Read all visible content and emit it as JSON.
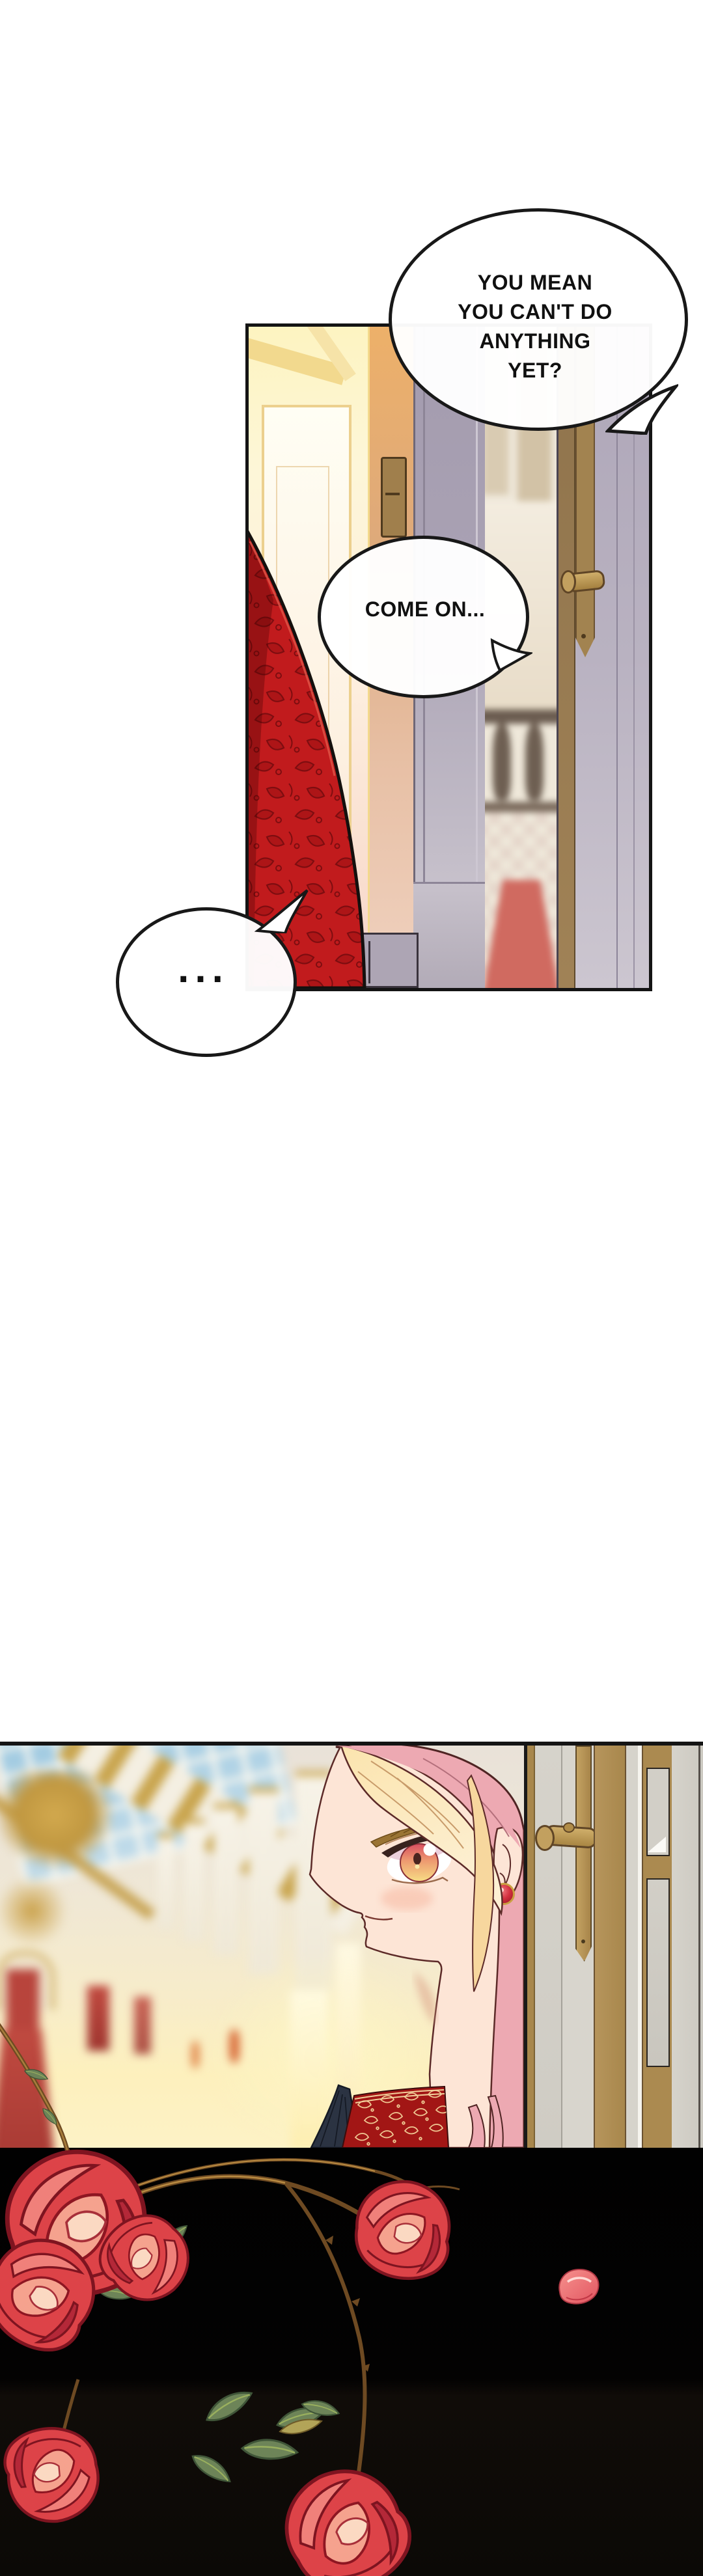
{
  "page": {
    "background": "#ffffff"
  },
  "bubbles": {
    "b1": {
      "lines": [
        "YOU MEAN",
        "YOU CAN'T DO",
        "ANYTHING",
        "YET?"
      ]
    },
    "b2": {
      "text": "COME ON..."
    },
    "b3": {
      "text": "..."
    }
  },
  "colors": {
    "panel_border": "#141414",
    "curtain_red": "#c11b1d",
    "curtain_pattern": "#7e0d10",
    "hair_pink": "#eda9b2",
    "hair_blonde": "#fbe4ae",
    "skin": "#fde5d6",
    "eye_red": "#e05a68",
    "eye_gold": "#f6d87e",
    "dress_navy": "#2b3342",
    "brocade_red": "#a21615",
    "brocade_gold": "#efc893",
    "rose_red": "#dd4348",
    "leaf_green": "#6d8458",
    "door_tan": "#ab8a50",
    "door_gray": "#d3d0c8",
    "black_panel": "#050403"
  }
}
